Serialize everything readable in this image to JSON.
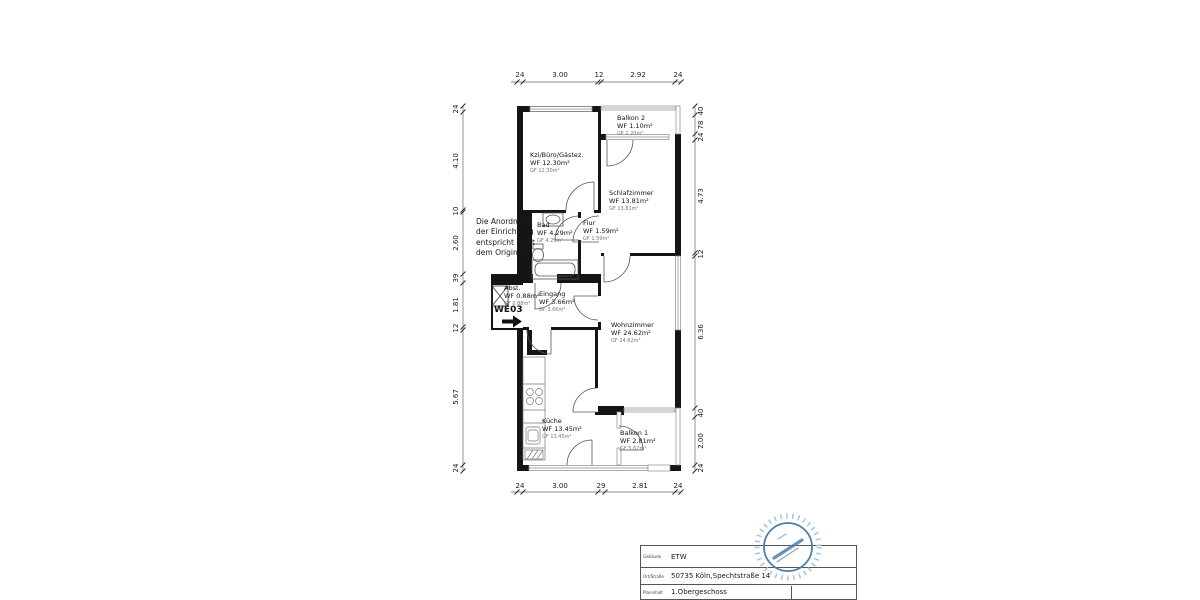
{
  "plan": {
    "unit_label": "WE03",
    "note_lines": [
      "Die Anordnung",
      "der Einrichtung",
      "entspricht nicht",
      "dem Original"
    ],
    "rooms": {
      "kzi": {
        "name": "Kzi/Büro/Gästez.",
        "wf": "WF 12.30m²",
        "gf": "GF 12.30m²"
      },
      "balkon2": {
        "name": "Balkon 2",
        "wf": "WF 1.10m²",
        "gf": "GF 2.20m²"
      },
      "schlafzimmer": {
        "name": "Schlafzimmer",
        "wf": "WF 13.81m²",
        "gf": "GF 13.81m²"
      },
      "bad": {
        "name": "Bad",
        "wf": "WF 4.29m²",
        "gf": "GF 4.29m²"
      },
      "flur": {
        "name": "Flur",
        "wf": "WF 1.59m²",
        "gf": "GF 1.59m²"
      },
      "abst": {
        "name": "Abst.",
        "wf": "WF 0.88m²",
        "gf": "GF 0.88m²"
      },
      "eingang": {
        "name": "Eingang",
        "wf": "WF 3.66m²",
        "gf": "GF 3.66m²"
      },
      "wohnzimmer": {
        "name": "Wohnzimmer",
        "wf": "WF 24.62m²",
        "gf": "GF 24.62m²"
      },
      "kueche": {
        "name": "Küche",
        "wf": "WF 13.45m²",
        "gf": "GF 13.45m²"
      },
      "balkon1": {
        "name": "Balkon 1",
        "wf": "WF 2.81m²",
        "gf": "GF 5.62m²"
      }
    },
    "dimensions": {
      "top": [
        "24",
        "3.00",
        "12",
        "2.92",
        "24"
      ],
      "bottom": [
        "24",
        "3.00",
        "29",
        "2.81",
        "24"
      ],
      "left": [
        "24",
        "4.10",
        "10",
        "2.60",
        "39",
        "1.81",
        "12",
        "5.67",
        "24"
      ],
      "right": [
        "40",
        "78",
        "24",
        "4.73",
        "12",
        "6.36",
        "40",
        "2.00",
        "24"
      ]
    }
  },
  "title_block": {
    "rows": [
      {
        "label": "Gebäude",
        "value": "ETW"
      },
      {
        "label": "Ort/Straße",
        "value": "50735 Köln,Spechtstraße 14"
      },
      {
        "label": "Planinhalt",
        "value": "1.Obergeschoss"
      }
    ]
  },
  "stamp": {
    "color": "#4d7ea9"
  }
}
